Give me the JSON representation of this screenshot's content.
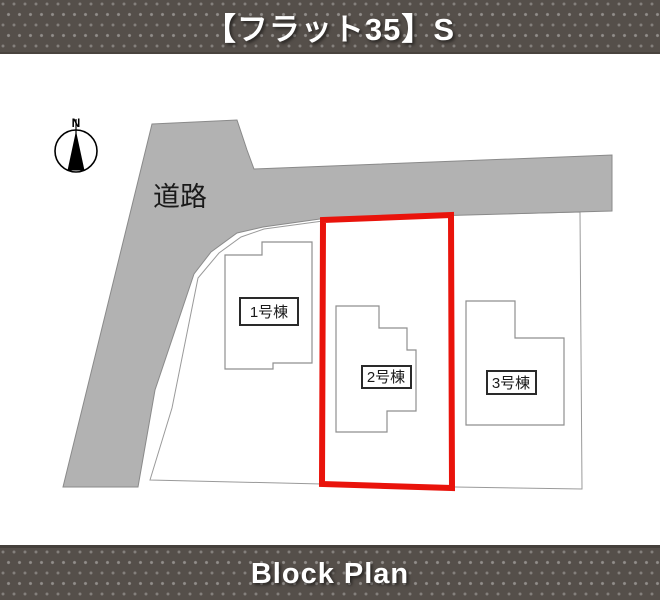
{
  "header": {
    "title": "【フラット35】S"
  },
  "footer": {
    "title": "Block Plan"
  },
  "plan": {
    "road_label": "道路",
    "compass": {
      "label": "N"
    },
    "lots": [
      {
        "id": "lot-1",
        "label": "1号棟",
        "highlighted": false
      },
      {
        "id": "lot-2",
        "label": "2号棟",
        "highlighted": true
      },
      {
        "id": "lot-3",
        "label": "3号棟",
        "highlighted": false
      }
    ]
  },
  "colors": {
    "banner_bg": "#554f4a",
    "banner_text": "#ffffff",
    "road_fill": "#b2b2b2",
    "road_stroke": "#8a8a8a",
    "site_fill": "#ffffff",
    "site_stroke": "#9a9a9a",
    "house_stroke": "#8f8f8f",
    "highlight_red": "#e9130b",
    "label_border": "#2a2a2a",
    "compass_color": "#000000"
  }
}
